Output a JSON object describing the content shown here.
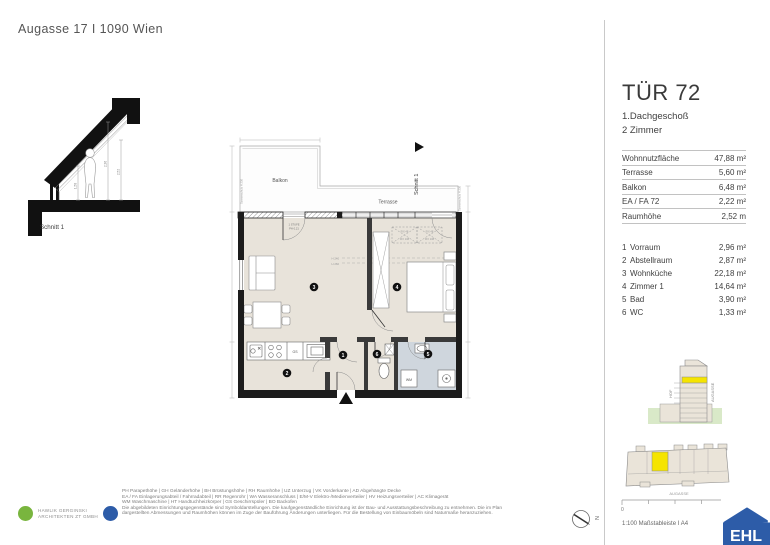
{
  "header": {
    "title": "Augasse 17 I 1090 Wien"
  },
  "section_drawing": {
    "label": "Schnitt 1",
    "dim_left": "1,58",
    "dim_mid": "2,36",
    "dim_right": "2,52"
  },
  "floor_plan": {
    "balcony_label": "Balkon",
    "terrace_label": "Terrasse",
    "schnitt_marker": "Schnitt 1",
    "kitchen_gs": "GS",
    "wm_label": "WM",
    "stufe_line1": "1 STUFE",
    "stufe_line2": "PH 0,21",
    "sonnenschutz_left": "Sonnenschutz H 230",
    "sonnenschutz_right": "Sonnenschutz H 230",
    "height_line1": "H 240",
    "height_line2": "H 260",
    "skylight_label_a": "FIX 48",
    "skylight_label_b": "FIX 138",
    "room_numbers": [
      "1",
      "2",
      "3",
      "4",
      "5",
      "6"
    ]
  },
  "unit_panel": {
    "title": "TÜR 72",
    "floor": "1.Dachgeschoß",
    "rooms": "2 Zimmer",
    "metrics": [
      {
        "label": "Wohnnutzfläche",
        "value": "47,88 m²"
      },
      {
        "label": "Terrasse",
        "value": "5,60 m²"
      },
      {
        "label": "Balkon",
        "value": "6,48 m²"
      },
      {
        "label": "EA / FA 72",
        "value": "2,22 m²"
      },
      {
        "label": "Raumhöhe",
        "value": "2,52 m"
      }
    ],
    "room_list": [
      {
        "no": "1",
        "name": "Vorraum",
        "area": "2,96 m²"
      },
      {
        "no": "2",
        "name": "Abstellraum",
        "area": "2,87 m²"
      },
      {
        "no": "3",
        "name": "Wohnküche",
        "area": "22,18 m²"
      },
      {
        "no": "4",
        "name": "Zimmer 1",
        "area": "14,64 m²"
      },
      {
        "no": "5",
        "name": "Bad",
        "area": "3,90 m²"
      },
      {
        "no": "6",
        "name": "WC",
        "area": "1,33 m²"
      }
    ]
  },
  "key_plan": {
    "hof_label": "HOF",
    "street_label_elevation": "AUGASSE",
    "street_label_site": "AUGASSE"
  },
  "footer": {
    "architect_line1": "HAWLIK GERGINSKI",
    "architect_line2": "ARCHITEKTEN ZT GMBH",
    "legend_line1": "PH Parapethöhe | GH Geländerhöhe | BH Brüstungshöhe  |  RH Raumhöhe | UZ Unterzug | VK Vorderkante | AD Abgehängte Decke",
    "legend_line2": "EA / FA Einlagerungsabteil / Fahrradabteil | RR Regenrohr | WA Wasseranschluss | E/M-V Elektro-/Medienverteiler | HV Heizungsverteiler | AC Klimagerät",
    "legend_line3": "WM Waschmaschine | HT Handtuchheizkörper | GS Geschirrspüler | BO Backofen",
    "disclaimer_line1": "Die abgebildeten Einrichtungsgegenstände sind Symboldarstellungen. Die kaufgegenständliche Einrichtung ist der Bau- und Ausstattungsbeschreibung zu entnehmen. Die im Plan",
    "disclaimer_line2": "dargestellten Abmessungen und Raumhöhen können im Zuge der Bauführung Änderungen unterliegen. Für die Bestellung von Einbaumöbeln sind Naturmaße heranzuziehen.",
    "north_label": "N",
    "scale_zero": "0",
    "scale_label": "1:100 Maßstableiste I A4",
    "ehl_logo": "EHL"
  },
  "colors": {
    "floor_beige": "#e8e3da",
    "bath_blue": "#cfd6dd",
    "highlight_yellow": "#f5e400",
    "ground_green": "#d9e9c8",
    "ehl_blue": "#2d5ca8",
    "architect_green": "#79b53e",
    "wall_black": "#1c1c1c"
  }
}
